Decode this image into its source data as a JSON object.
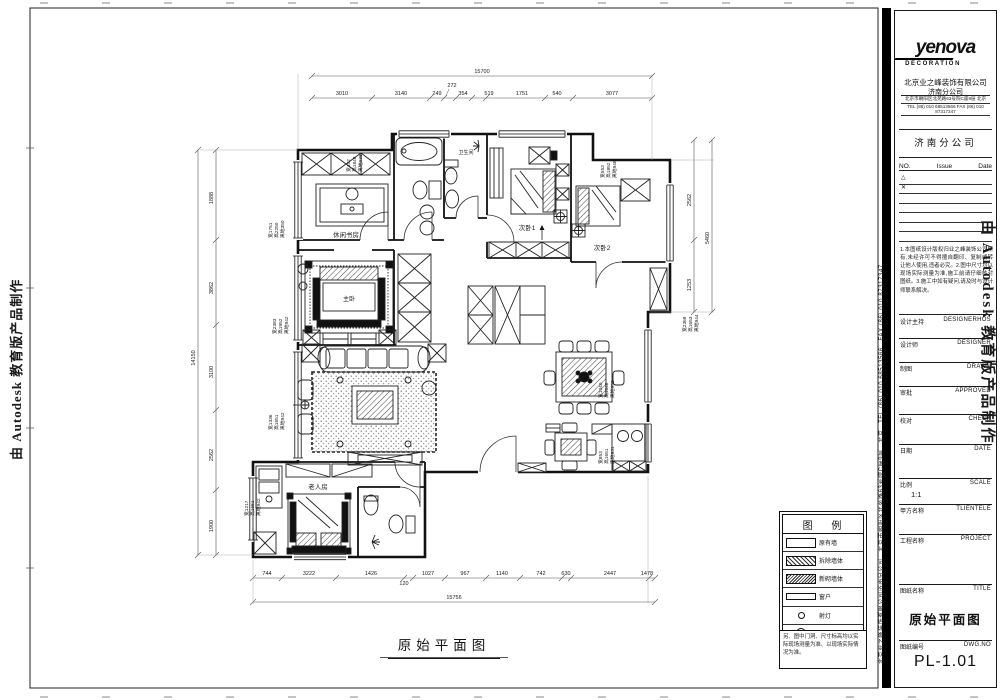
{
  "watermarks": {
    "autodesk": "由 Autodesk 教育版产品制作"
  },
  "side_contact": "北京业之峰装饰有限公司济南分公司　北京市朝阳区北苑路63号院C座9层　北京　TEL (86) 010 68513566　FAX (86) 010 87317347",
  "titleblock": {
    "logo_text": "yenova",
    "logo_sub": "DECORATION",
    "company_cn": "北京业之峰装饰有限公司",
    "company_branch_small": "济南分公司",
    "contact_row1": "北京市朝阳区北苑路63号院C座9层 北京",
    "contact_row2": "TEL (86) 010 68513566  FAX (86) 010 87317347",
    "branch": "济南分公司",
    "rev_no": "NO.",
    "rev_issue": "Issue",
    "rev_date": "Date",
    "rev_row1": "△",
    "rev_row2": "✕",
    "disclaimer": "1.本图纸设计版权归业之峰装饰公司所有,未经许可不得擅自翻印、复制或转让他人使用,违者必究。2.图中尺寸均以现场实际测量为准,施工前请仔细核对图纸。3.施工中如有疑问,请及时与设计师联系解决。",
    "fields": [
      {
        "cn": "设计主持",
        "en": "DESIGNERHOS"
      },
      {
        "cn": "设计师",
        "en": "DESIGNER"
      },
      {
        "cn": "制图",
        "en": "DRAWN"
      },
      {
        "cn": "审批",
        "en": "APPROVED"
      },
      {
        "cn": "校对",
        "en": "CHECK"
      },
      {
        "cn": "日期",
        "en": "DATE"
      },
      {
        "cn": "比例",
        "en": "SCALE"
      },
      {
        "cn": "甲方名称",
        "en": "TLIENTELE"
      },
      {
        "cn": "工程名称",
        "en": "PROJECT"
      },
      {
        "cn": "图纸名称",
        "en": "TITLE"
      },
      {
        "cn": "图纸编号",
        "en": "DWG.NO"
      }
    ],
    "scale_value": "1:1",
    "drawing_title": "原始平面图",
    "dwg_no": "PL-1.01"
  },
  "legend": {
    "title": "图  例",
    "rows": [
      {
        "label": "原有墙"
      },
      {
        "label": "拆除墙体"
      },
      {
        "label": "新砌墙体"
      },
      {
        "label": "窗户"
      },
      {
        "label": "射灯"
      },
      {
        "label": "吸顶灯"
      },
      {
        "label": "地漏"
      }
    ],
    "note": "另、图中门洞、尺寸标高均以实际现场测量为准、以现场实际情况为准。"
  },
  "plan": {
    "caption": "原始平面图",
    "rooms": [
      {
        "label": "休闲书房"
      },
      {
        "label": "主卧"
      },
      {
        "label": "次卧1"
      },
      {
        "label": "次卧2"
      },
      {
        "label": "老人房"
      },
      {
        "label": "卫生间"
      }
    ],
    "window_notes": [
      {
        "lines": [
          "宽1751",
          "高2250",
          "离地350"
        ]
      },
      {
        "lines": [
          "宽452",
          "高1848",
          "离地938"
        ]
      },
      {
        "lines": [
          "宽553",
          "高1852",
          "离地948"
        ]
      },
      {
        "lines": [
          "宽2369",
          "高1653",
          "离地944"
        ]
      },
      {
        "lines": [
          "宽1040",
          "高1648",
          "离地952"
        ]
      },
      {
        "lines": [
          "宽853",
          "高1651",
          "离地931"
        ]
      },
      {
        "lines": [
          "宽2383",
          "高1952",
          "离地942"
        ]
      },
      {
        "lines": [
          "宽1336",
          "高1651",
          "离地942"
        ]
      },
      {
        "lines": [
          "宽1217",
          "高1651",
          "离地942"
        ]
      }
    ],
    "dims": {
      "top_overall": "15700",
      "top": [
        "3010",
        "3140",
        "249",
        "272",
        "354",
        "519",
        "1751",
        "540",
        "3077"
      ],
      "bottom": [
        "744",
        "3222",
        "1426",
        "120",
        "1027",
        "967",
        "1140",
        "742",
        "630",
        "2447",
        "1478"
      ],
      "bottom_overall": "15756",
      "left": [
        "1888",
        "3862",
        "3100",
        "2562",
        "1900"
      ],
      "left_overall": "14150",
      "right": [
        "2562",
        "1253",
        "5460"
      ]
    }
  }
}
